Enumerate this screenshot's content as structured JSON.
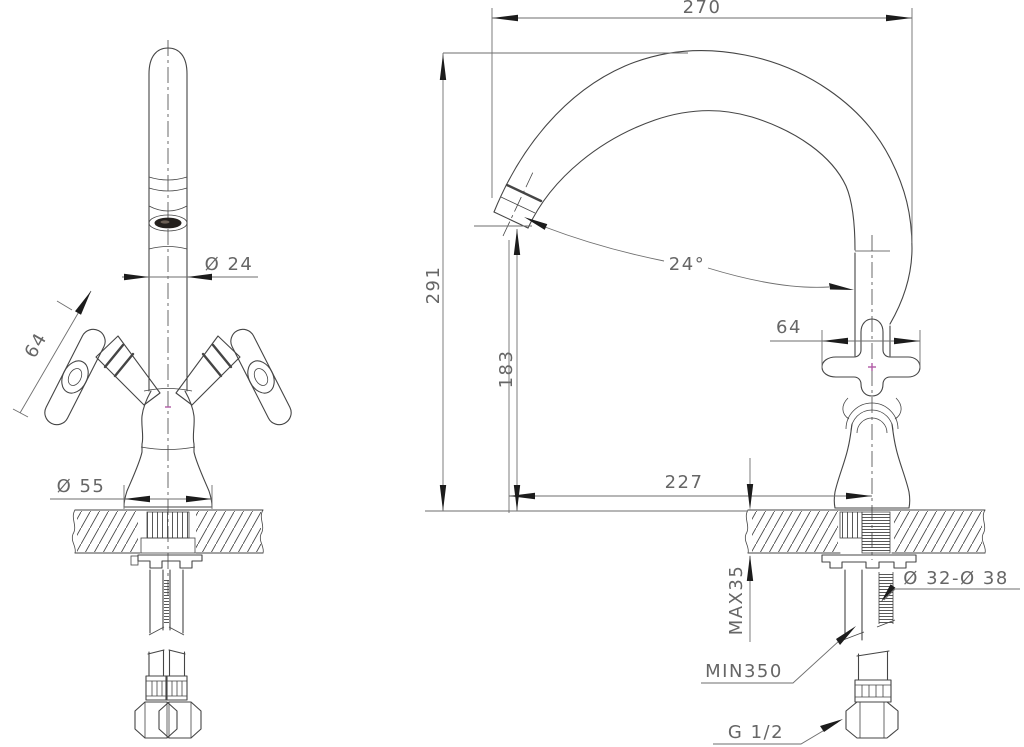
{
  "colors": {
    "background": "#ffffff",
    "line": "#454545",
    "dimension": "#6e6e6e",
    "text": "#666666",
    "arrow": "#1c1c1c",
    "accent_center_mark": "#b05ba6",
    "aerator_dark": "#24201d"
  },
  "front_view": {
    "spout_diameter": "Ø 24",
    "handle_span": "64",
    "base_diameter": "Ø 55"
  },
  "side_view": {
    "spout_reach": "270",
    "overall_height": "291",
    "outlet_height": "183",
    "outlet_angle": "24°",
    "handle_span": "64",
    "reach_to_axis": "227",
    "max_counter_thickness": "MAX35",
    "mounting_hole_diameter": "Ø 32-Ø 38",
    "min_clearance": "MIN350",
    "connection_thread": "G 1/2"
  }
}
